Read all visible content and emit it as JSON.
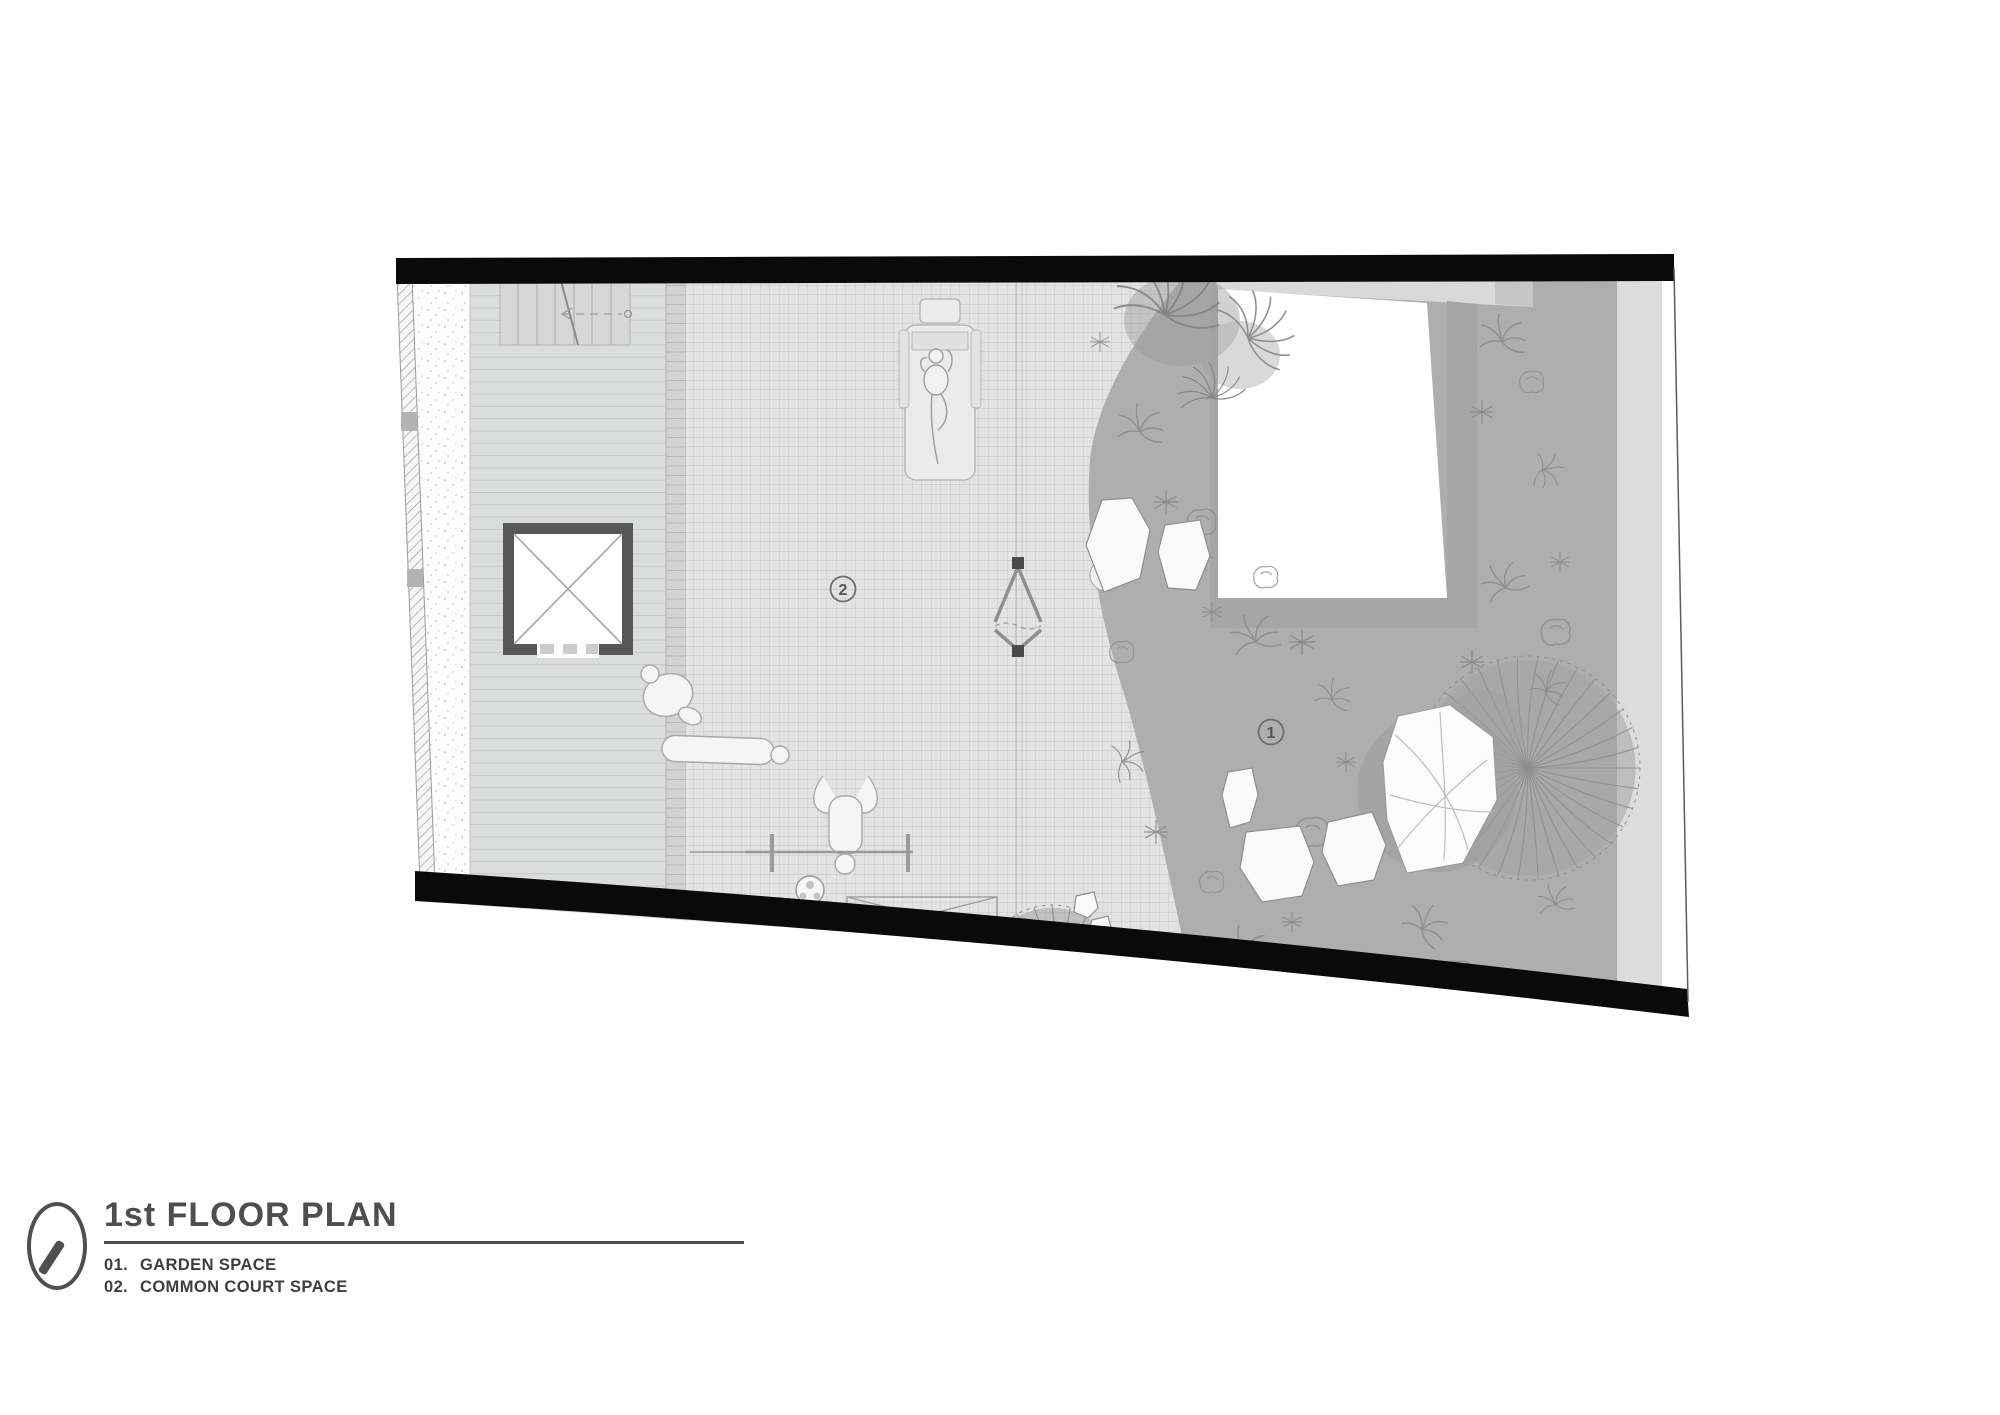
{
  "title_block": {
    "icon": "compass-needle-icon",
    "title": "1st FLOOR PLAN",
    "legend": [
      {
        "num": "01.",
        "label": "GARDEN SPACE"
      },
      {
        "num": "02.",
        "label": "COMMON COURT SPACE"
      }
    ]
  },
  "plan": {
    "markers": {
      "garden": "1",
      "court": "2"
    }
  },
  "colors": {
    "wall_black": "#0a0a0a",
    "text_gray": "#4e4e4e",
    "garden_gray": "#aeaeae",
    "court_gray": "#e3e3e3",
    "building_border_gray": "#a6a6a6"
  }
}
